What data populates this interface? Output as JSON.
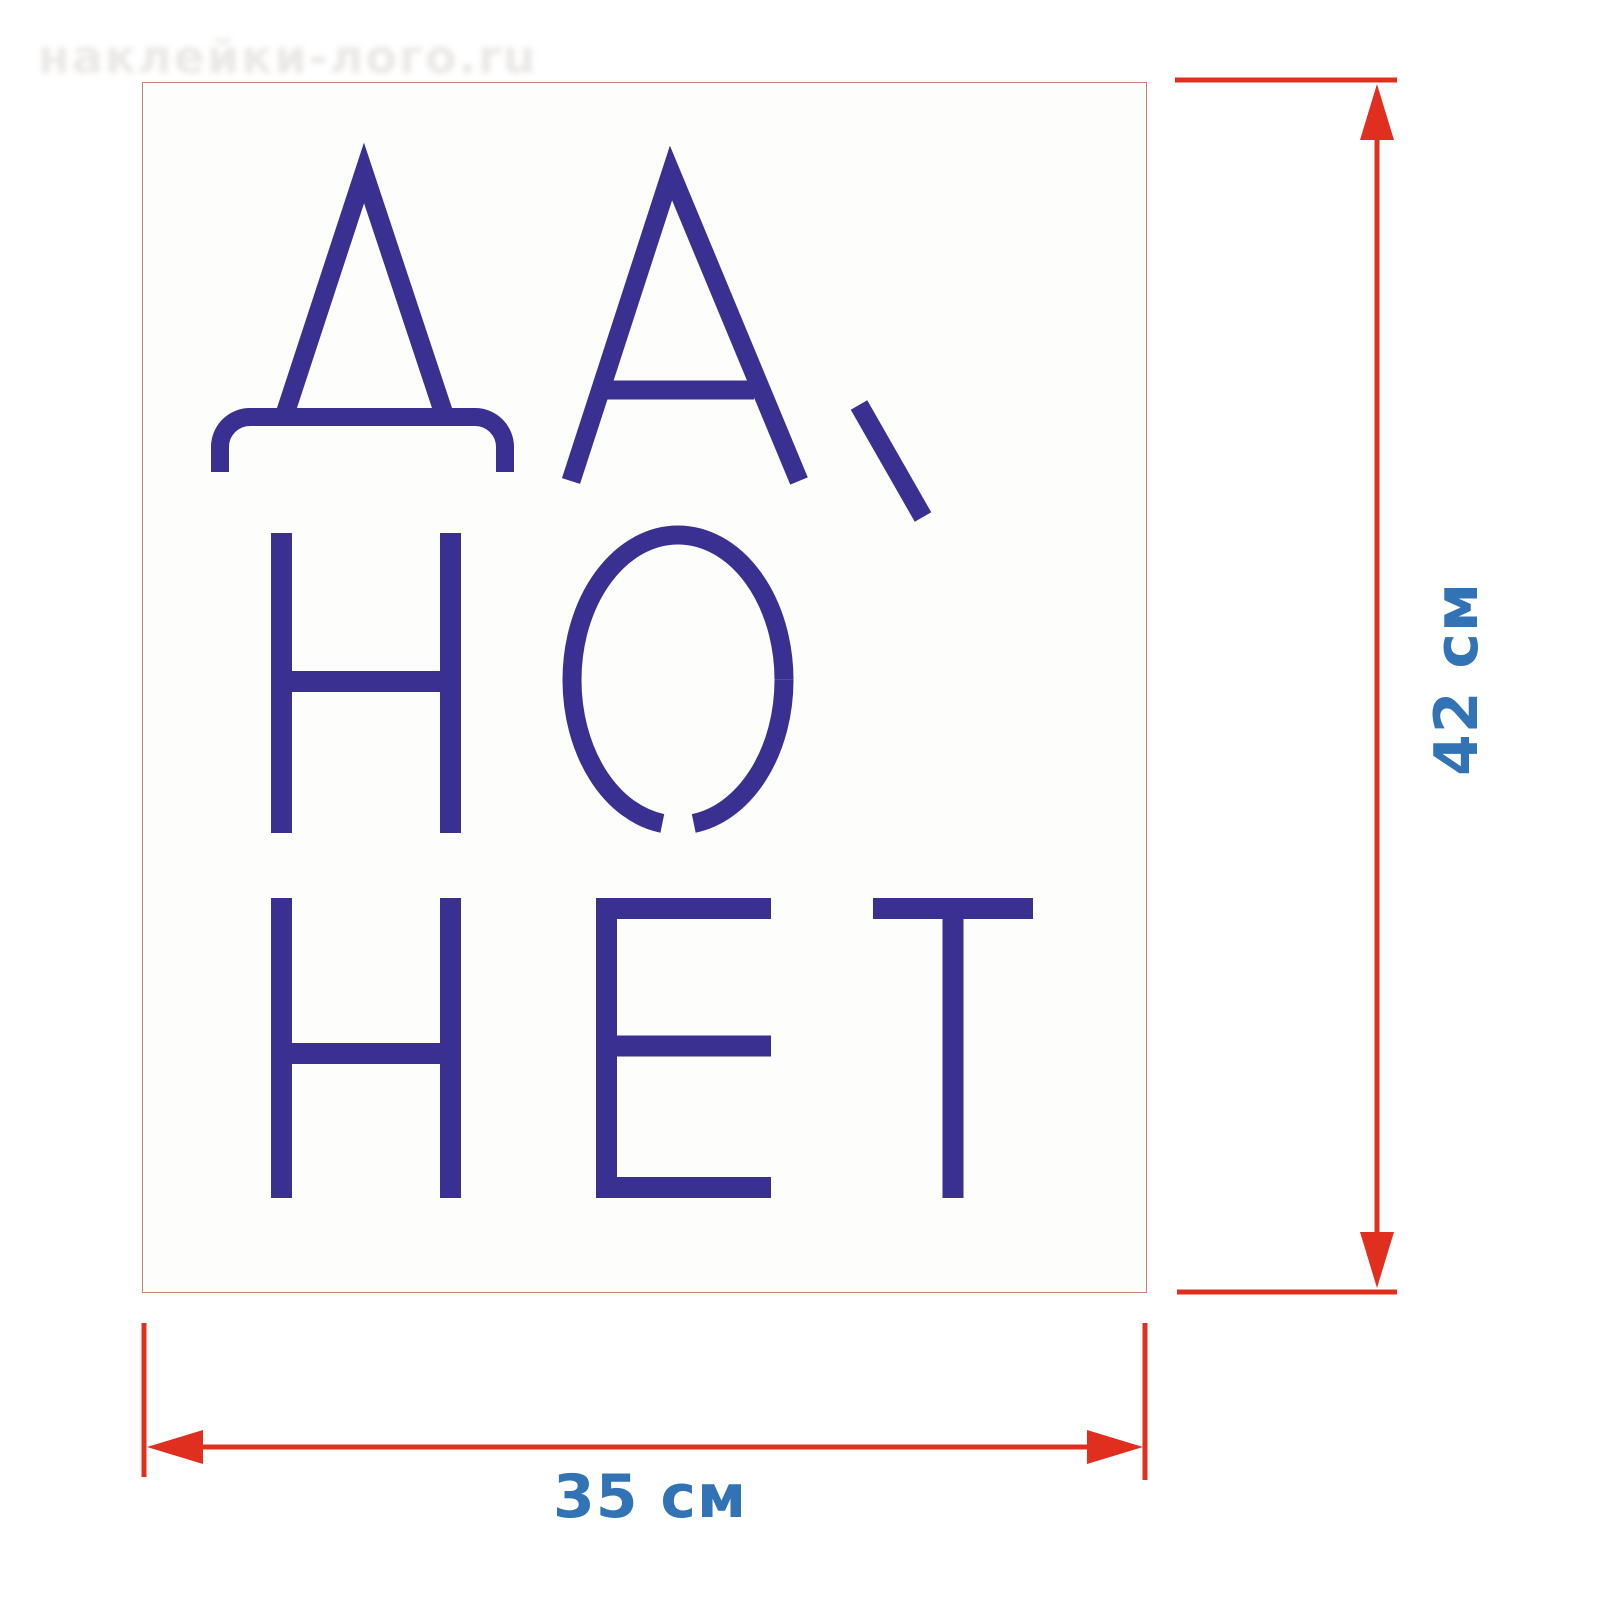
{
  "page": {
    "background_color": "#ffffff"
  },
  "watermark": {
    "text": "наклейки-лого.ru"
  },
  "sticker": {
    "text": "ДА, НО НЕТ",
    "lines": [
      "ДА,",
      "НО",
      "НЕТ"
    ],
    "letter_color": "#3A3092",
    "border_color": "#BE3C2D",
    "background": "#fdfdfc"
  },
  "dimensions": {
    "height": {
      "value": "42 см"
    },
    "width": {
      "value": "35 см"
    },
    "line_color": "#E02F1F",
    "label_color": "#3273B5"
  }
}
